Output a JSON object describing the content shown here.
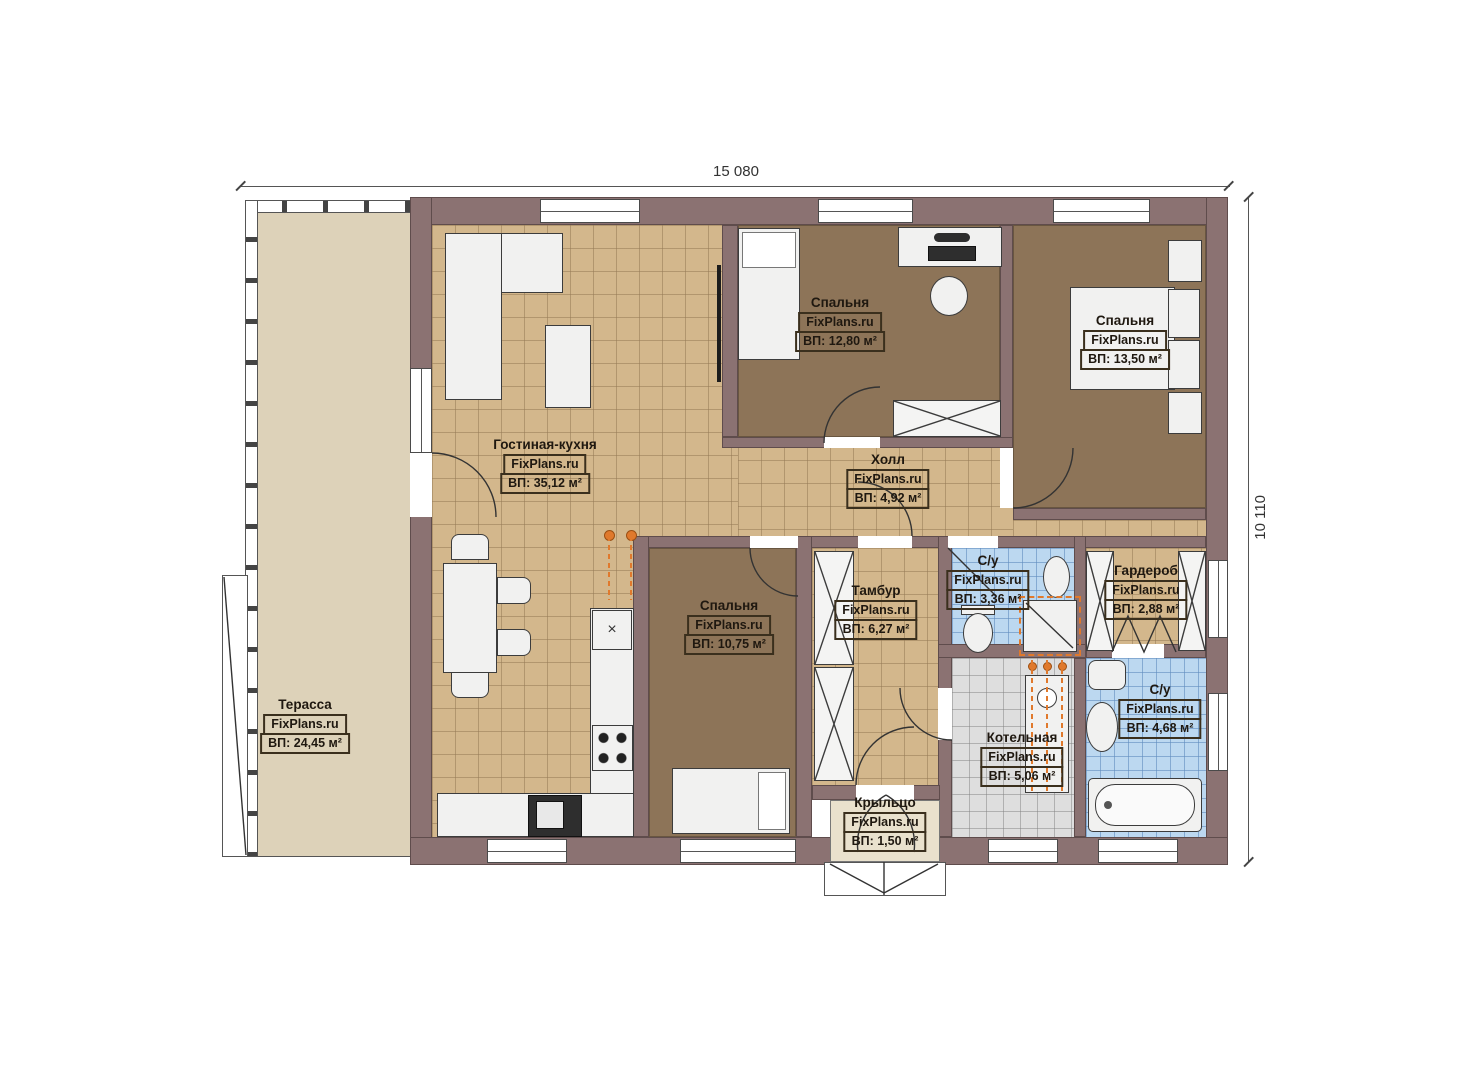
{
  "title": "Floor plan",
  "dimensions": {
    "top": "15 080",
    "right": "10 110"
  },
  "watermark": "FixPlans.ru",
  "rooms": [
    {
      "name": "Терасса",
      "watermark": "FixPlans.ru",
      "area": "ВП: 24,45 м²"
    },
    {
      "name": "Гостиная-кухня",
      "watermark": "FixPlans.ru",
      "area": "ВП: 35,12 м²"
    },
    {
      "name": "Спальня",
      "watermark": "FixPlans.ru",
      "area": "ВП: 12,80 м²"
    },
    {
      "name": "Спальня",
      "watermark": "FixPlans.ru",
      "area": "ВП: 13,50 м²"
    },
    {
      "name": "Холл",
      "watermark": "FixPlans.ru",
      "area": "ВП: 4,92 м²"
    },
    {
      "name": "Спальня",
      "watermark": "FixPlans.ru",
      "area": "ВП: 10,75 м²"
    },
    {
      "name": "Тамбур",
      "watermark": "FixPlans.ru",
      "area": "ВП: 6,27 м²"
    },
    {
      "name": "С/у",
      "watermark": "FixPlans.ru",
      "area": "ВП: 3,36 м²"
    },
    {
      "name": "Гардероб",
      "watermark": "FixPlans.ru",
      "area": "ВП: 2,88 м²"
    },
    {
      "name": "Котельная",
      "watermark": "FixPlans.ru",
      "area": "ВП: 5,06 м²"
    },
    {
      "name": "С/у",
      "watermark": "FixPlans.ru",
      "area": "ВП: 4,68 м²"
    },
    {
      "name": "Крыльцо",
      "watermark": "FixPlans.ru",
      "area": "ВП: 1,50 м²"
    }
  ],
  "icons": {
    "dishwasher_mark": "×"
  },
  "colors": {
    "wall": "#8b7272",
    "floor_tile_tan": "#d3b78c",
    "floor_carpet_brown": "#8d7458",
    "floor_tile_blue": "#bcd8f0",
    "floor_tile_gray": "#dedede",
    "terrace": "#ddd2b9",
    "accent_orange": "#e0792c"
  }
}
